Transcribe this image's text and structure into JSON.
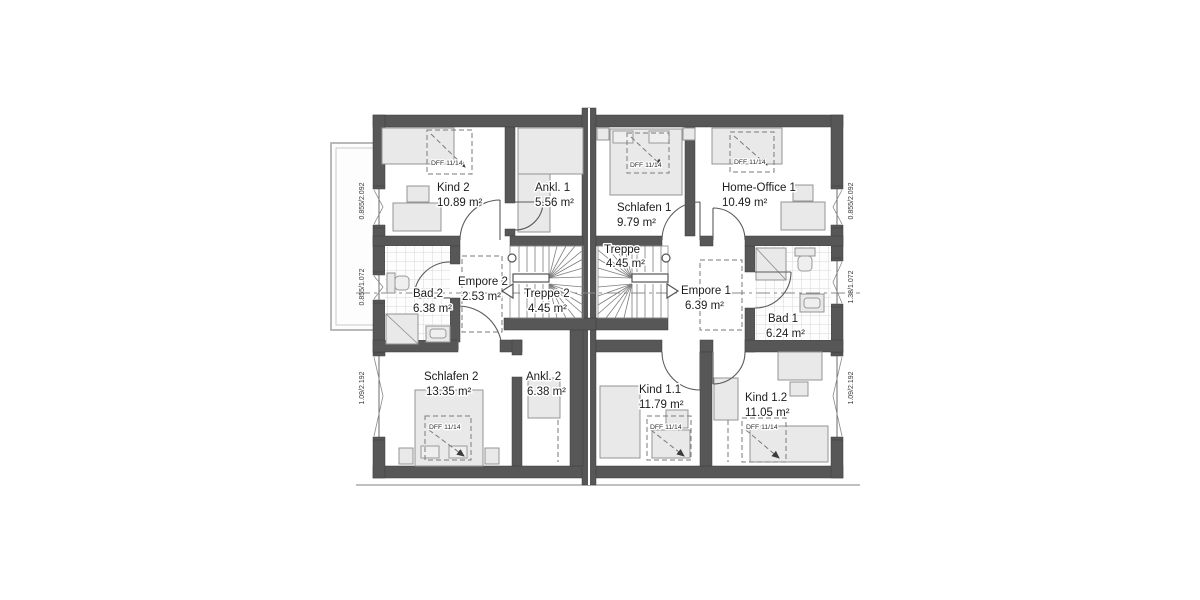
{
  "plan": {
    "title": "Obergeschoss Grundriss",
    "rooms": [
      {
        "id": "kind-2",
        "name": "Kind 2",
        "area": "10.89 m²"
      },
      {
        "id": "ankl-1",
        "name": "Ankl. 1",
        "area": "5.56 m²"
      },
      {
        "id": "schlafen-1",
        "name": "Schlafen 1",
        "area": "9.79 m²"
      },
      {
        "id": "home-office-1",
        "name": "Home-Office 1",
        "area": "10.49 m²"
      },
      {
        "id": "bad-2",
        "name": "Bad 2",
        "area": "6.38 m²"
      },
      {
        "id": "empore-2",
        "name": "Empore 2",
        "area": "2.53 m²"
      },
      {
        "id": "treppe-2",
        "name": "Treppe 2",
        "area": "4.45 m²"
      },
      {
        "id": "treppe",
        "name": "Treppe",
        "area": "4.45 m²"
      },
      {
        "id": "empore-1",
        "name": "Empore 1",
        "area": "6.39 m²"
      },
      {
        "id": "bad-1",
        "name": "Bad 1",
        "area": "6.24 m²"
      },
      {
        "id": "schlafen-2",
        "name": "Schlafen 2",
        "area": "13.35 m²"
      },
      {
        "id": "ankl-2",
        "name": "Ankl. 2",
        "area": "6.38 m²"
      },
      {
        "id": "kind-1-1",
        "name": "Kind 1.1",
        "area": "11.79 m²"
      },
      {
        "id": "kind-1-2",
        "name": "Kind 1.2",
        "area": "11.05 m²"
      }
    ],
    "skylight_label": "DFF 11/14",
    "window_labels": {
      "left_top": "0.855/2.092",
      "left_middle": "0.855/1.072",
      "left_bottom": "1.09/2.192",
      "right_top": "0.855/2.092",
      "right_middle": "1.38/1.072",
      "right_bottom": "1.09/2.192"
    },
    "colors": {
      "wall": "#575757",
      "furniture_fill": "#e9e9e9",
      "furniture_stroke": "#949494",
      "tile_line": "#d8d8d8",
      "text": "#1c1c1c",
      "background": "#ffffff"
    }
  }
}
